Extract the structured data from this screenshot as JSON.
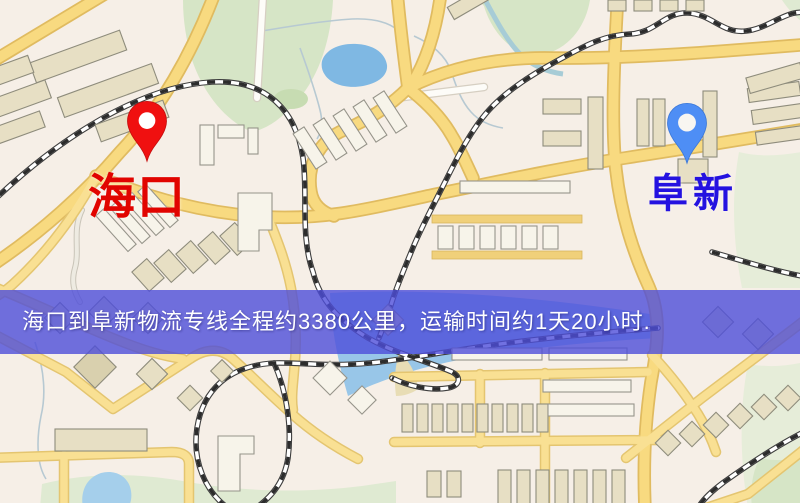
{
  "origin": {
    "label": "海口",
    "pin_color": "#f01010",
    "label_color": "#e10400"
  },
  "destination": {
    "label": "阜新",
    "pin_color": "#4e8ef5",
    "label_color": "#2412e0"
  },
  "banner": {
    "text": "海口到阜新物流专线全程约3380公里，运输时间约1天20小时.",
    "background_color": "#4d4dda",
    "text_color": "#ffffff"
  }
}
